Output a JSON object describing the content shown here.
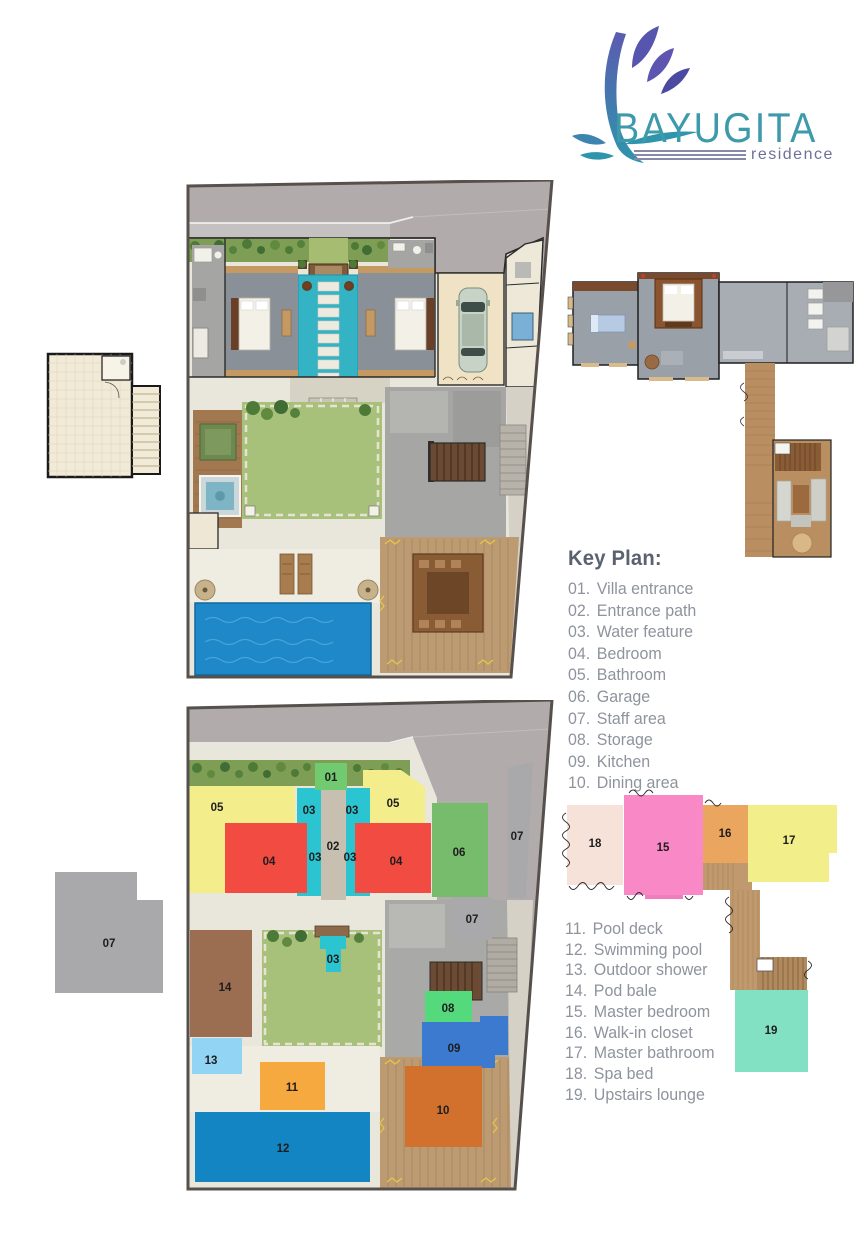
{
  "logo": {
    "title": "BAYUGITA",
    "subtitle": "residence",
    "title_color": "#3d9aab",
    "subtitle_color": "#6f7099",
    "flourish_purple": "#5656ae",
    "flourish_teal": "#2f95ac"
  },
  "key_plan": {
    "title": "Key Plan:",
    "items": [
      {
        "num": "01.",
        "label": "Villa entrance"
      },
      {
        "num": "02.",
        "label": "Entrance path"
      },
      {
        "num": "03.",
        "label": "Water feature"
      },
      {
        "num": "04.",
        "label": "Bedroom"
      },
      {
        "num": "05.",
        "label": "Bathroom"
      },
      {
        "num": "06.",
        "label": "Garage"
      },
      {
        "num": "07.",
        "label": "Staff area"
      },
      {
        "num": "08.",
        "label": "Storage"
      },
      {
        "num": "09.",
        "label": "Kitchen"
      },
      {
        "num": "10.",
        "label": "Dining area"
      }
    ]
  },
  "legend_upper": {
    "items": [
      {
        "num": "11.",
        "label": "Pool deck"
      },
      {
        "num": "12.",
        "label": "Swimming pool"
      },
      {
        "num": "13.",
        "label": "Outdoor shower"
      },
      {
        "num": "14.",
        "label": "Pod bale"
      },
      {
        "num": "15.",
        "label": "Master bedroom"
      },
      {
        "num": "16.",
        "label": "Walk-in closet"
      },
      {
        "num": "17.",
        "label": "Master bathroom"
      },
      {
        "num": "18.",
        "label": "Spa bed"
      },
      {
        "num": "19.",
        "label": "Upstairs lounge"
      }
    ]
  },
  "blocks": {
    "n01": {
      "label": "01",
      "color": "#72ca70"
    },
    "n02": {
      "label": "02",
      "color": "#c7bfb0"
    },
    "n03": {
      "label": "03",
      "color": "#2bc5d2"
    },
    "n04": {
      "label": "04",
      "color": "#f14b42"
    },
    "n05": {
      "label": "05",
      "color": "#f4ed8c"
    },
    "n06": {
      "label": "06",
      "color": "#77bb6d"
    },
    "n07": {
      "label": "07",
      "color": "#a9a9ab"
    },
    "n08": {
      "label": "08",
      "color": "#55d97d"
    },
    "n09": {
      "label": "09",
      "color": "#3c7ad0"
    },
    "n10": {
      "label": "10",
      "color": "#d2712e"
    },
    "n11": {
      "label": "11",
      "color": "#f6a93e"
    },
    "n12": {
      "label": "12",
      "color": "#1385c2"
    },
    "n13": {
      "label": "13",
      "color": "#92d4f3"
    },
    "n14": {
      "label": "14",
      "color": "#9b6e52"
    },
    "n15": {
      "label": "15",
      "color": "#f988c6"
    },
    "n16": {
      "label": "16",
      "color": "#eaa55f"
    },
    "n17": {
      "label": "17",
      "color": "#f2ee89"
    },
    "n18": {
      "label": "18",
      "color": "#f7e2d9"
    },
    "n19": {
      "label": "19",
      "color": "#83e1c3"
    }
  }
}
